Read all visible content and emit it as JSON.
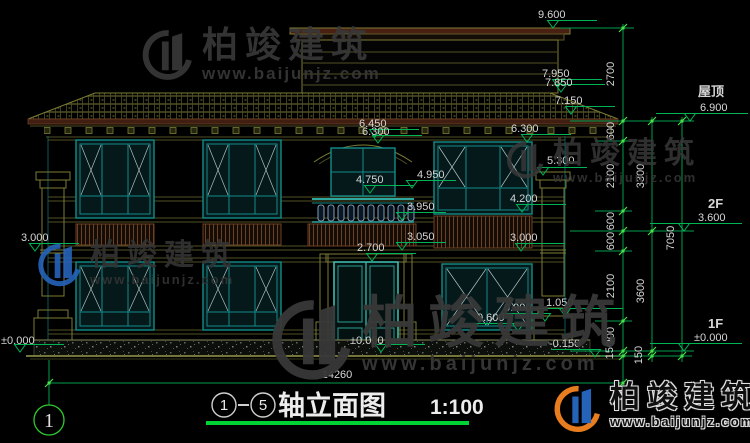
{
  "colors": {
    "background": "#000000",
    "dimension_green": "#00b455",
    "tick_lime": "#49e049",
    "dimension_text": "#d6d6d6",
    "line_olive": "#7c7c34",
    "line_teal": "#128c88",
    "band_brown": "#6e4023",
    "title_underline": "#00d435",
    "watermark_blue": "#2563b8",
    "watermark_orange": "#e87d1f"
  },
  "watermark": {
    "brand": "柏竣建筑",
    "url": "www.baijunjz.com"
  },
  "levels": {
    "l9600": "9.600",
    "l7950": "7.950",
    "l7850": "7.850",
    "l7150": "7.150",
    "l6450": "6.450",
    "l6300c": "6.300",
    "l6300r": "6.300",
    "l5300": "5.300",
    "l4950": "4.950",
    "l4750": "4.750",
    "l4200": "4.200",
    "l3950": "3.950",
    "l3050": "3.050",
    "l3000r": "3.000",
    "l3000l": "3.000",
    "l2700": "2.700",
    "l1050": "1.050",
    "l0900": "0.900",
    "l0600": "0.600",
    "l0000l": "±0.000",
    "l0000d": "±0.000",
    "lm0150": "-0.150"
  },
  "story_labels": {
    "roof_name": "屋顶",
    "roof_level": "6.900",
    "f2_name": "2F",
    "f2_level": "3.600",
    "f1_name": "1F",
    "f1_level": "±0.000"
  },
  "dims": {
    "chain_a": [
      "2700",
      "600",
      "2100",
      "600",
      "600",
      "2100",
      "900",
      "150"
    ],
    "chain_b": [
      "3300",
      "3600",
      "150"
    ],
    "chain_c": [
      "7050"
    ],
    "total_width": "14260"
  },
  "grid": {
    "label": "1"
  },
  "title_block": {
    "axis_start": "1",
    "axis_end": "5",
    "title": "轴立面图",
    "scale": "1:100"
  }
}
